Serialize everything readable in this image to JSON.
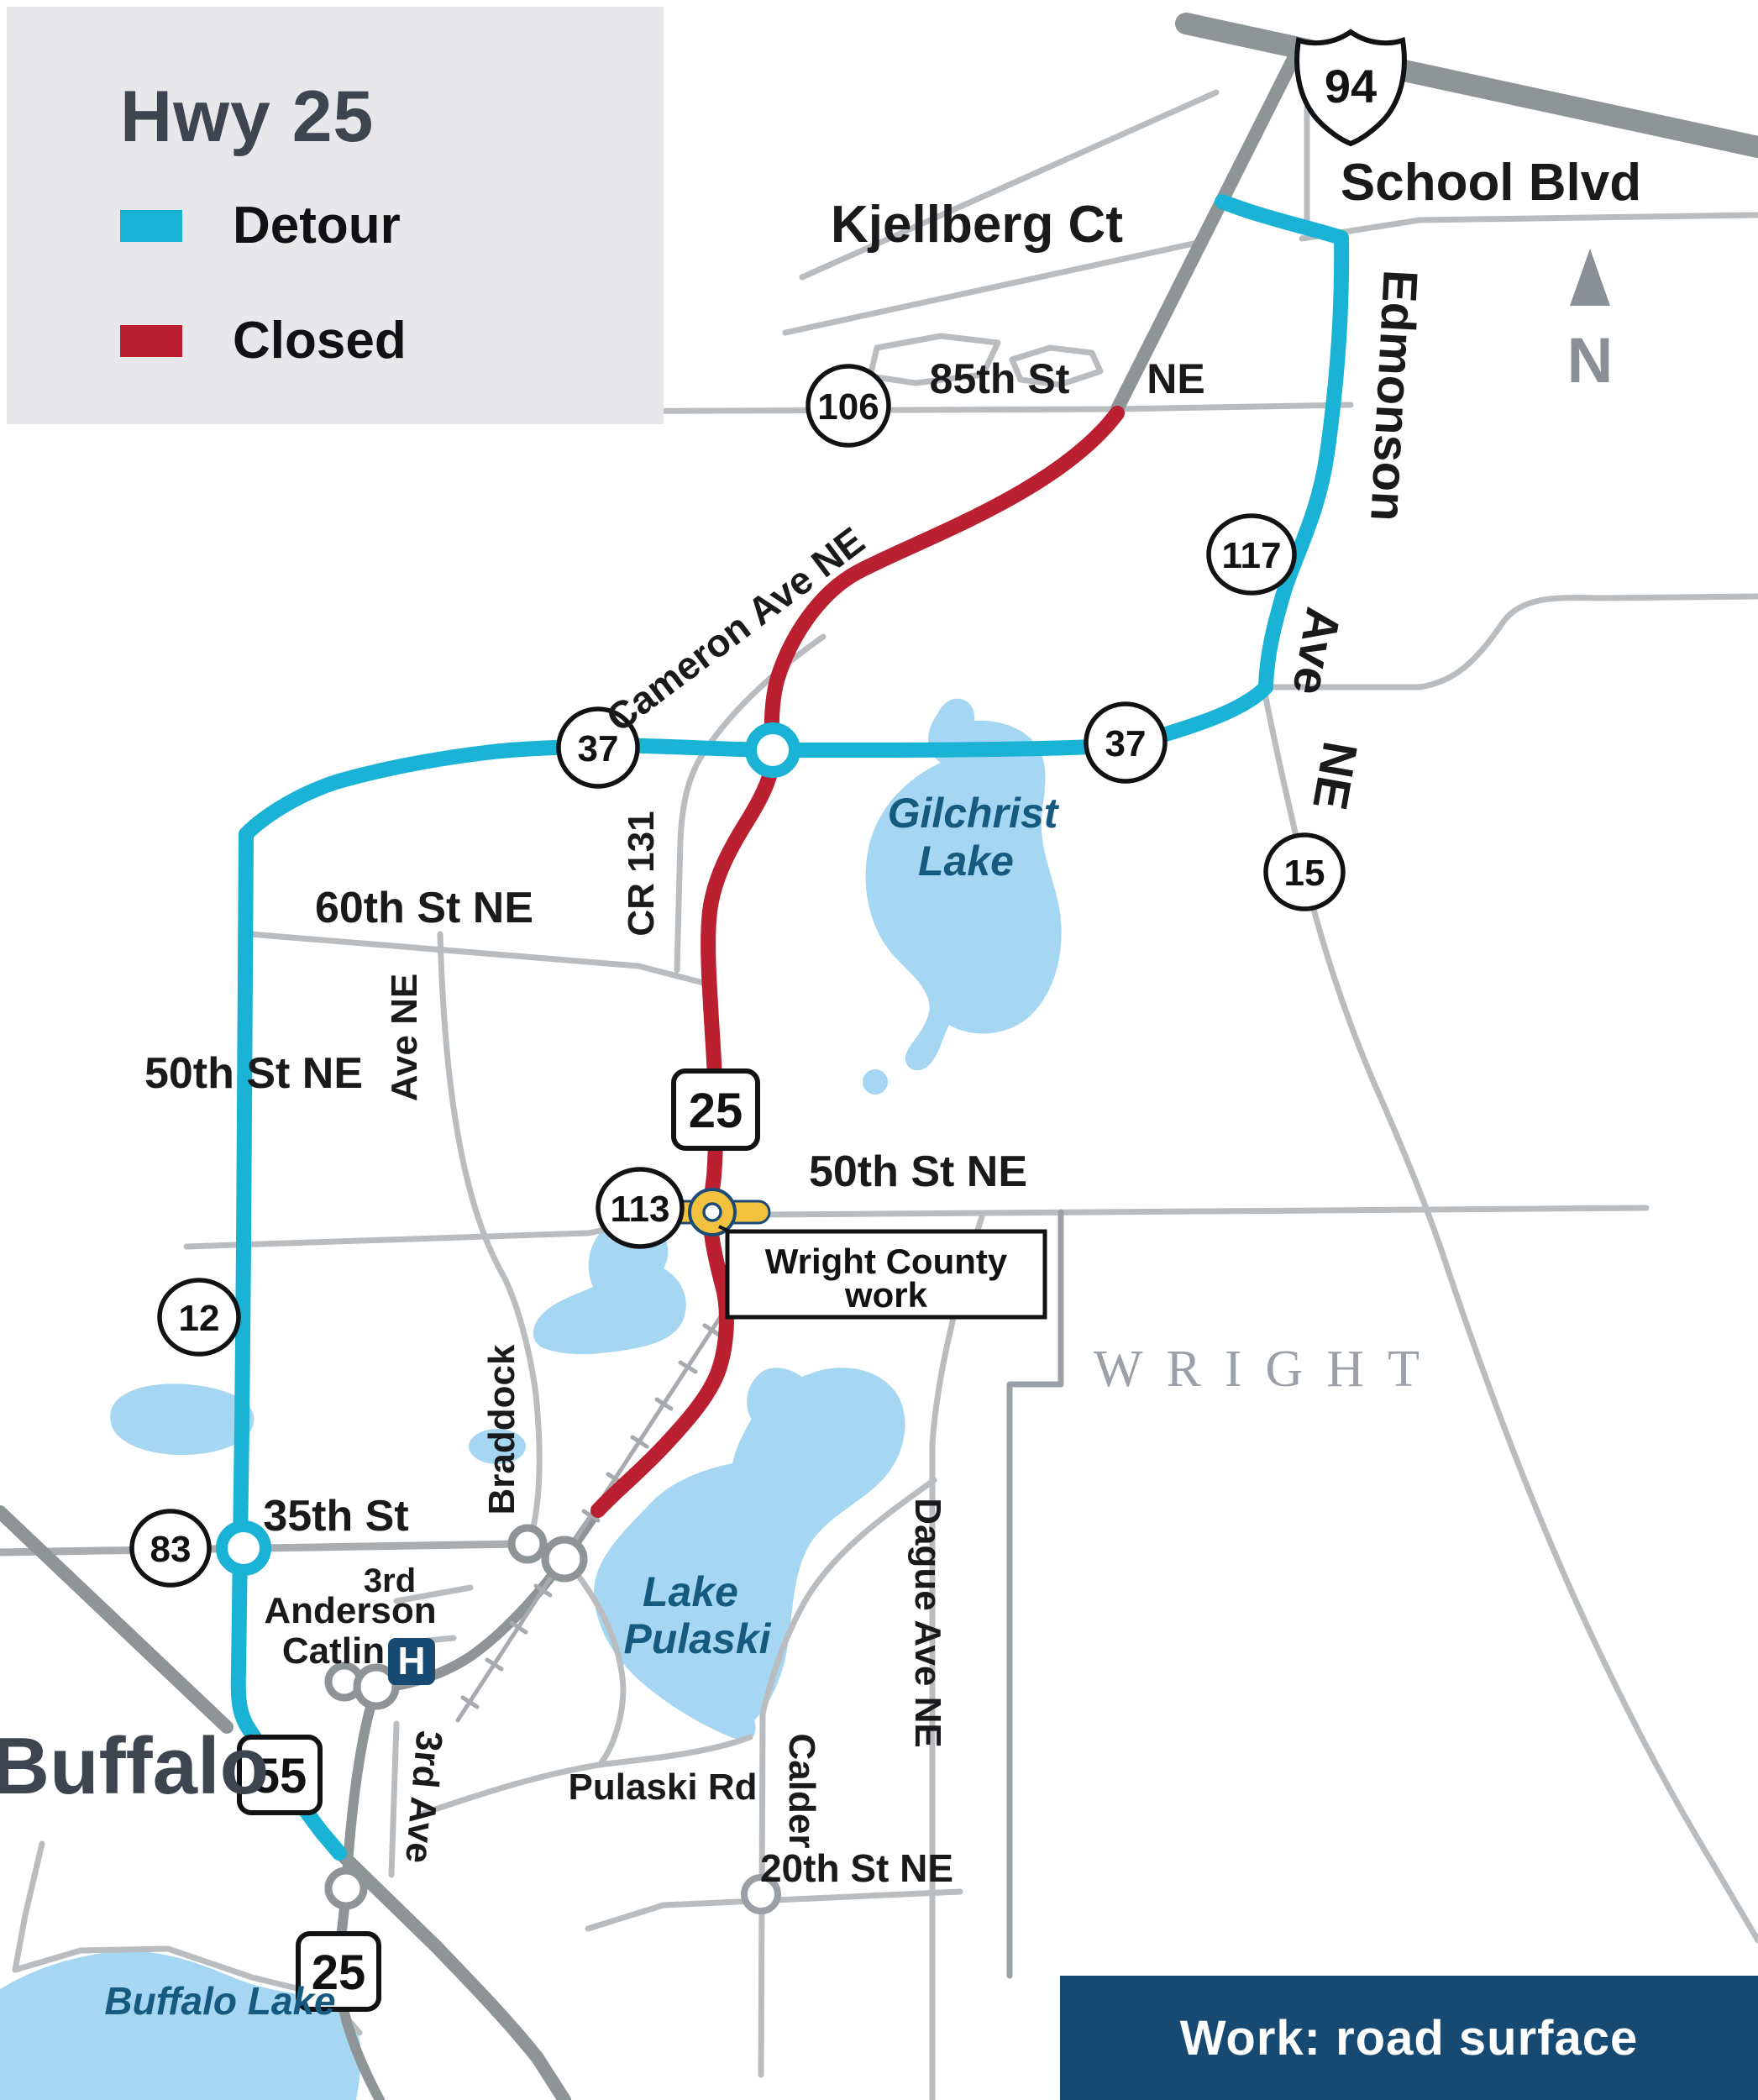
{
  "legend": {
    "title": "Hwy 25",
    "detour_label": "Detour",
    "closed_label": "Closed",
    "detour_color": "#1ab3d6",
    "closed_color": "#bb2031"
  },
  "banner": {
    "label": "Work: road surface",
    "color": "#174a73"
  },
  "compass": {
    "label": "N"
  },
  "city": {
    "buffalo": "Buffalo"
  },
  "county": {
    "wright": "WRIGHT"
  },
  "callout": {
    "line1": "Wright County",
    "line2": "work"
  },
  "hospital": {
    "label": "H"
  },
  "shields": {
    "i94": "94",
    "mn25_mid": "25",
    "mn25_south": "25",
    "mn55": "55",
    "cr106": "106",
    "cr117": "117",
    "cr37_west": "37",
    "cr37_east": "37",
    "cr15": "15",
    "cr113": "113",
    "cr12": "12",
    "cr83": "83"
  },
  "streets": {
    "kjellberg_ct": "Kjellberg Ct",
    "school_blvd": "School Blvd",
    "st_85th": "85th St",
    "st_85th_ne": "NE",
    "edmonson": "Edmonson",
    "edmonson_ave": "Ave",
    "edmonson_ne": "NE",
    "cameron_ave": "Cameron Ave NE",
    "cr_131": "CR 131",
    "st_60th": "60th St NE",
    "braddock_ave_ne": "Ave NE",
    "braddock": "Braddock",
    "st_50th_left": "50th  St NE",
    "st_50th_right": "50th  St NE",
    "st_35th": "35th St",
    "third": "3rd",
    "anderson": "Anderson",
    "catlin": "Catlin",
    "pulaski_rd": "Pulaski Rd",
    "third_ave": "3rd Ave",
    "calder": "Calder",
    "dague_ave_ne": "Dague Ave NE",
    "st_20th": "20th St NE"
  },
  "lakes": {
    "gilchrist_1": "Gilchrist",
    "gilchrist_2": "Lake",
    "pulaski_1": "Lake",
    "pulaski_2": "Pulaski",
    "buffalo_lake": "Buffalo Lake"
  },
  "colors": {
    "detour": "#1ab3d6",
    "closed": "#bb2031",
    "trunk_road": "#8f9497",
    "minor_road": "#b9bdc0",
    "lake_fill": "#a5d7f3",
    "work_marker": "#f2c23e",
    "navy": "#174a73"
  }
}
